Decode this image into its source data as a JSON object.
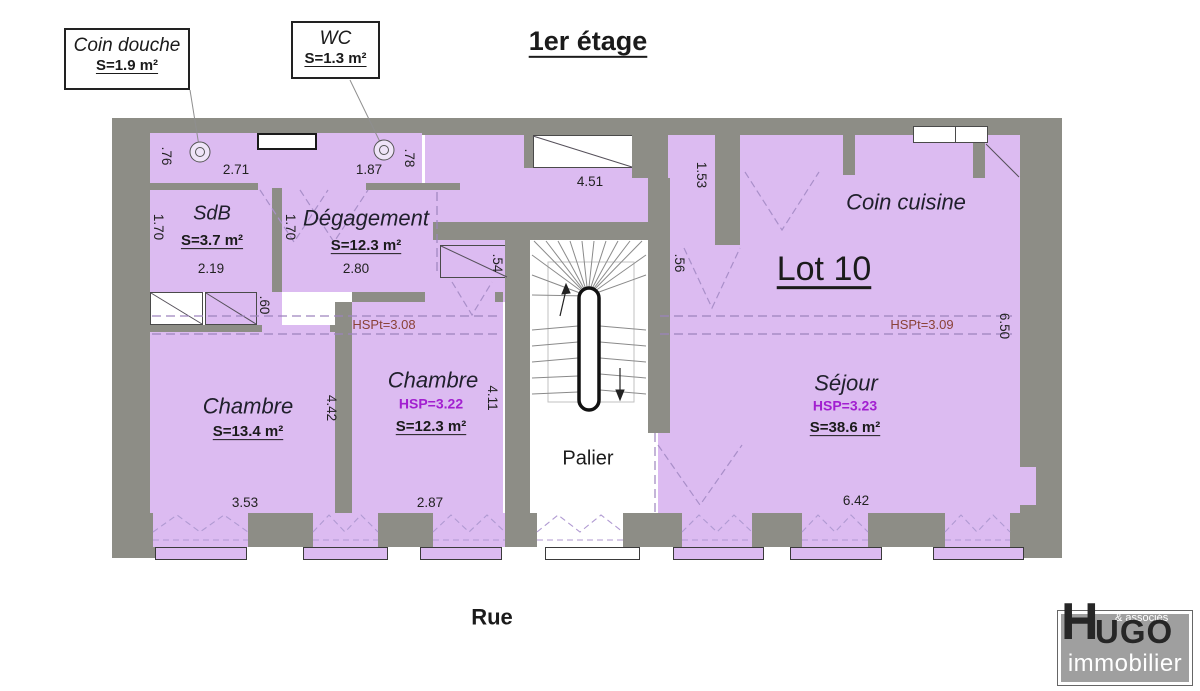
{
  "title": "1er étage",
  "street": "Rue",
  "callouts": {
    "coin_douche": {
      "name": "Coin douche",
      "area": "S=1.9 m²"
    },
    "wc": {
      "name": "WC",
      "area": "S=1.3 m²"
    }
  },
  "rooms": {
    "sdb": {
      "name": "SdB",
      "area": "S=3.7 m²"
    },
    "degagement": {
      "name": "Dégagement",
      "area": "S=12.3 m²"
    },
    "chambre1": {
      "name": "Chambre",
      "area": "S=13.4 m²"
    },
    "chambre2": {
      "name": "Chambre",
      "hsp": "HSP=3.22",
      "area": "S=12.3 m²"
    },
    "sejour": {
      "name": "Séjour",
      "hsp": "HSP=3.23",
      "area": "S=38.6 m²"
    },
    "coin_cuisine": {
      "name": "Coin cuisine"
    },
    "palier": {
      "name": "Palier"
    },
    "lot": {
      "name": "Lot 10"
    }
  },
  "ceiling": {
    "left": "HSPt=3.08",
    "right": "HSPt=3.09"
  },
  "dims": {
    "alcove1_depth": ".76",
    "alcove1_width": "2.71",
    "alcove2_width": "1.87",
    "alcove2_depth": ".78",
    "corridor_top_width": "4.51",
    "corridor_right_height": "1.53",
    "sdb_height": "1.70",
    "sdb_width": "2.19",
    "degagement_height": "1.70",
    "degagement_width": "2.80",
    "flue_width": ".60",
    "closet_depth": ".54",
    "door_width": ".56",
    "chambre1_width": "3.53",
    "chambre1_height": "4.42",
    "chambre2_width": "2.87",
    "chambre2_height": "4.11",
    "sejour_width": "6.42",
    "sejour_height": "6.50"
  },
  "logo": {
    "top": "& associés",
    "h": "H",
    "rest": "UGO",
    "sub": "immobilier"
  },
  "colors": {
    "wall": "#8d8d86",
    "room": "#dcbbf1",
    "hsp": "#a21fd0",
    "hspt": "#8a4238"
  }
}
